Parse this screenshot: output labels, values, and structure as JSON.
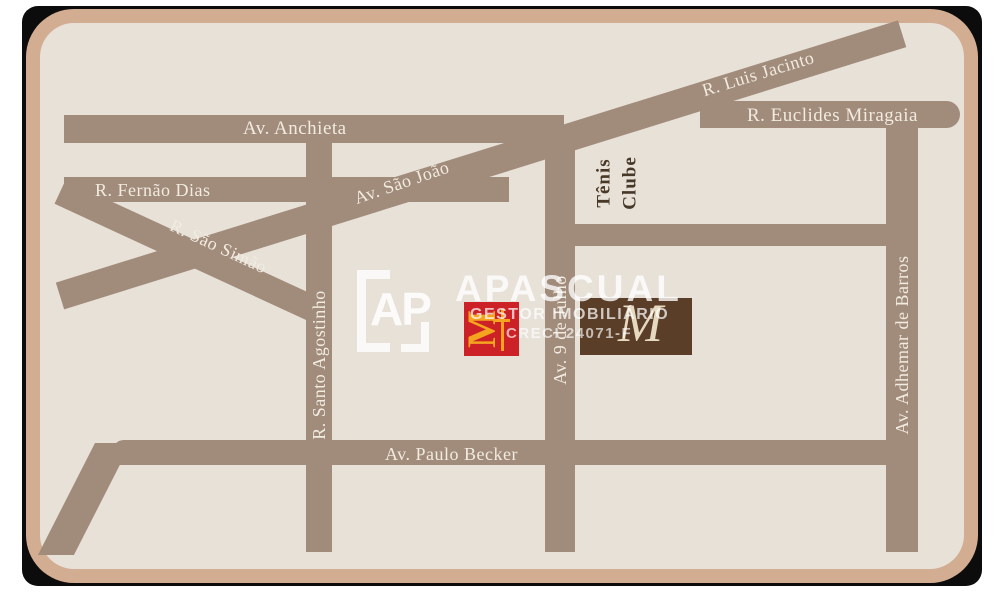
{
  "colors": {
    "page": "#ffffff",
    "card": "#0c0c0c",
    "frame": "#d3ad92",
    "interior": "#e7e1d8",
    "road": "#a18b7b",
    "label": "#f1ebe0",
    "dark_label": "#483827",
    "mcd_red": "#cc2126",
    "mcd_arches": "#f4a41f",
    "brown": "#5a3e28",
    "monogram": "#e7d9bf"
  },
  "map": {
    "road_labels": {
      "anchieta": "Av. Anchieta",
      "fernao_dias": "R. Fernão Dias",
      "sao_simao": "R. São Simão",
      "sao_joao": "Av. São João",
      "luis_jacinto": "R. Luis Jacinto",
      "euclides_miragaia": "R. Euclides Miragaia",
      "santo_agostinho": "R. Santo Agostinho",
      "nove_de_julho": "Av. 9 de Julho",
      "adhemar_de_barros": "Av. Adhemar de Barros",
      "paulo_becker": "Av. Paulo Becker"
    },
    "landmark": {
      "tenis_line1": "Tênis",
      "tenis_line2": "Clube"
    },
    "mcdonalds_letter": "M",
    "monogram_letter": "M"
  },
  "watermark": {
    "initials": "AP",
    "brand": "APASCUAL",
    "tagline": "GESTOR IMOBILIÁRIO",
    "creci": "CRECI 24071-F"
  }
}
